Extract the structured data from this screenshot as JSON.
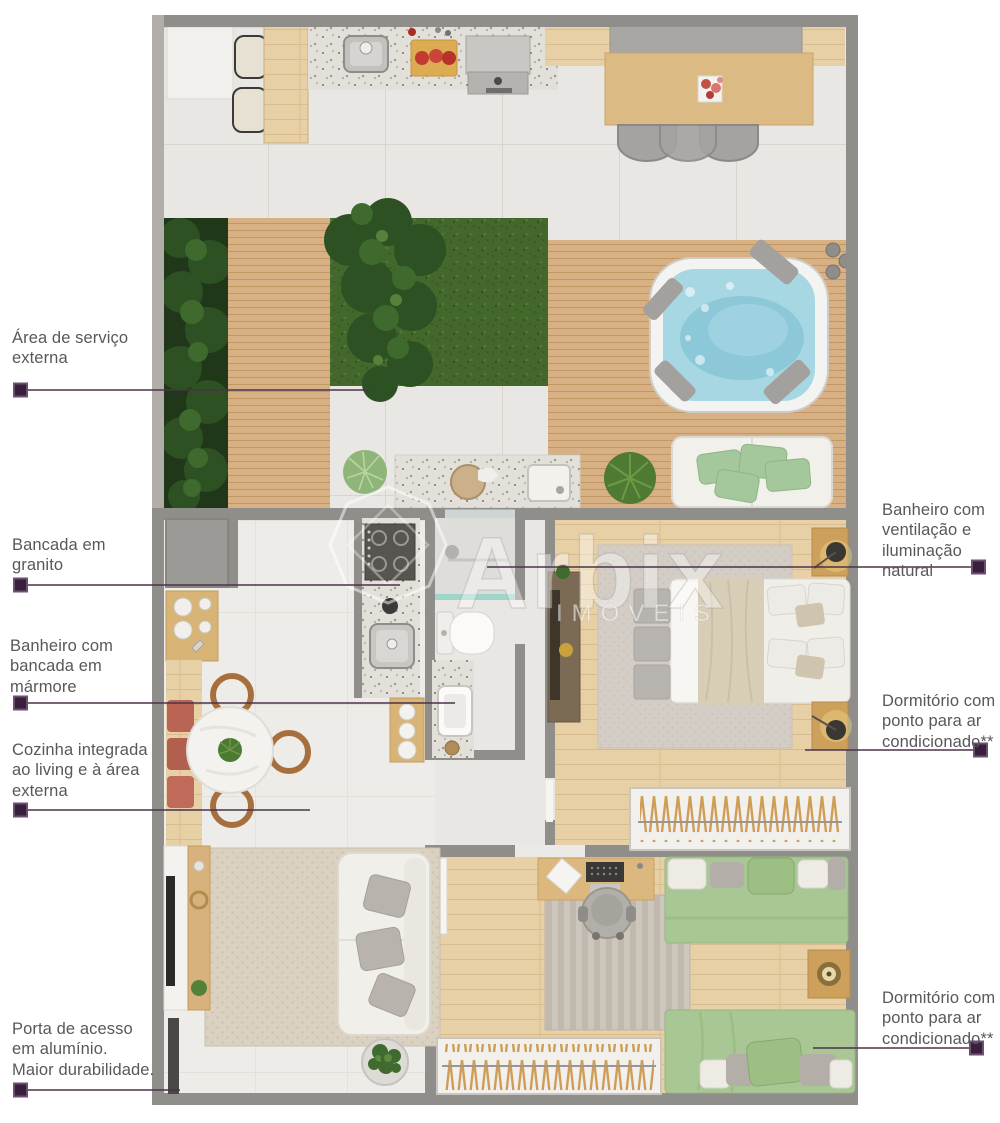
{
  "page": {
    "type": "apartment-floor-plan-render",
    "background": "#ffffff"
  },
  "watermark": {
    "brand": "Arbix",
    "subtitle": "IMÓVEIS"
  },
  "callouts": {
    "items": [
      {
        "id": "area-servico-externa",
        "side": "left",
        "label": "Área de serviço\nexterna"
      },
      {
        "id": "bancada-granito",
        "side": "left",
        "label": "Bancada em\ngranito"
      },
      {
        "id": "banheiro-marmore",
        "side": "left",
        "label": "Banheiro com\nbancada em\nmármore"
      },
      {
        "id": "cozinha-integrada",
        "side": "left",
        "label": "Cozinha integrada\nao living e à área\nexterna"
      },
      {
        "id": "porta-acesso",
        "side": "left",
        "label": "Porta de acesso\nem alumínio.\nMaior durabilidade."
      },
      {
        "id": "banheiro-ventilacao",
        "side": "right",
        "label": "Banheiro com\nventilação e\niluminação natural"
      },
      {
        "id": "dormitorio-ar-1",
        "side": "right",
        "label": "Dormitório com\nponto para ar\ncondicionado**"
      },
      {
        "id": "dormitorio-ar-2",
        "side": "right",
        "label": "Dormitório com\nponto para ar\ncondicionado**"
      }
    ]
  },
  "colors": {
    "callout_line": "#4a3349",
    "callout_marker": "#38203c",
    "label_text": "#58585a",
    "wall": "#908e8b",
    "wall_light": "#b1aeaa",
    "deck_wood": "#d7b183",
    "grass": "#44672c",
    "wood_floor": "#e8d0a6",
    "jacuzzi_water": "#a6d7e3",
    "sofa_cushion_green": "#a5c79c",
    "bed_green": "#a9c795",
    "dining_cushion_red": "#b96455"
  },
  "plan": {
    "features": [
      "outdoor-kitchen",
      "bar-stools",
      "grill",
      "dining-table",
      "garden-beds",
      "wood-deck",
      "grass-patch",
      "jacuzzi",
      "outdoor-sofa",
      "service-counter",
      "kitchen-island-cooktop",
      "fridge",
      "round-dining-table",
      "bathroom-toilet",
      "bathroom-sink",
      "master-bedroom-double-bed",
      "wardrobe",
      "living-room-sofa",
      "tv-console",
      "rug",
      "bedroom2-desk",
      "bedroom2-single-beds",
      "wardrobe-2",
      "aluminum-access-door"
    ]
  }
}
